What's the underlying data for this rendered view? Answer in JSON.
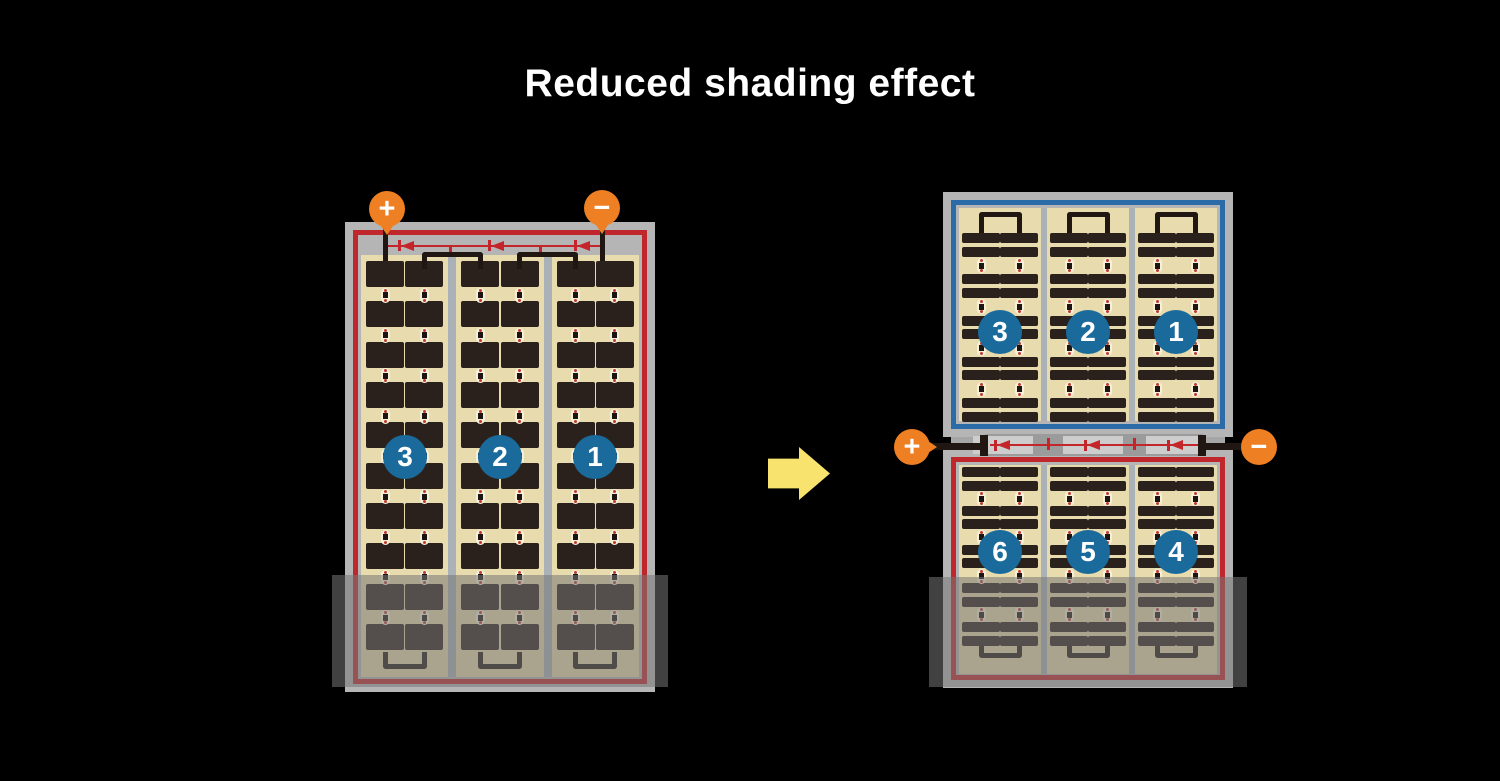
{
  "title": "Reduced shading effect",
  "arrow_direction": "right",
  "before_panel": {
    "terminals": {
      "positive": "+",
      "negative": "−"
    },
    "cell_strings": [
      {
        "label": "3"
      },
      {
        "label": "2"
      },
      {
        "label": "1"
      }
    ],
    "structure": {
      "columns": 3,
      "rows": 10,
      "cells_per_column_row": 2,
      "bypass_diodes": 3
    },
    "shaded_bottom": true
  },
  "after_panel": {
    "terminals": {
      "positive": "+",
      "negative": "−"
    },
    "top_half_strings": [
      {
        "label": "3"
      },
      {
        "label": "2"
      },
      {
        "label": "1"
      }
    ],
    "bottom_half_strings": [
      {
        "label": "6"
      },
      {
        "label": "5"
      },
      {
        "label": "4"
      }
    ],
    "structure": {
      "columns": 3,
      "bar_row_groups_per_half": 5,
      "bypass_diodes": 3
    },
    "shaded_bottom": true
  },
  "colors": {
    "background": "#000000",
    "panel_frame": "#b5b5b5",
    "red_outline": "#c0272c",
    "blue_outline": "#2b6ca8",
    "cell_background": "#e8dcae",
    "cell_dark": "#2b211c",
    "string_badge_blue": "#1a6b9c",
    "terminal_orange": "#ee7f22",
    "wire_red": "#c4252b",
    "arrow_yellow": "#f8e36e"
  }
}
